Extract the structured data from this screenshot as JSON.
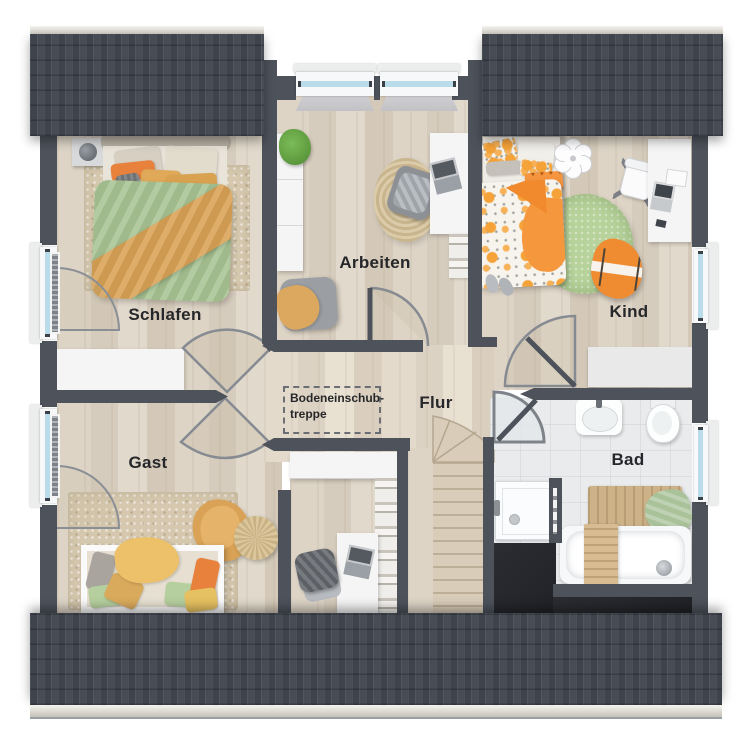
{
  "rooms": {
    "schlafen": "Schlafen",
    "arbeiten": "Arbeiten",
    "kind": "Kind",
    "gast": "Gast",
    "flur": "Flur",
    "bad": "Bad"
  },
  "note": {
    "line1": "Bodeneinschub-",
    "line2": "treppe"
  },
  "palette": {
    "wall": "#4d525b",
    "roof": "#454952",
    "roof_ridge": "#d9d5cc",
    "floor_wood": "#dcd3c5",
    "bathroom_tile": "#e9ebed",
    "void": "#26282c",
    "accent_orange": "#ee8a35",
    "accent_ochre": "#d9a256",
    "accent_green": "#a9c795",
    "rug_green": "#b7d29b",
    "window_glass": "#badbe9",
    "furniture_white": "#f5f5f6"
  },
  "plan_type": "floorplan-upper-storey"
}
